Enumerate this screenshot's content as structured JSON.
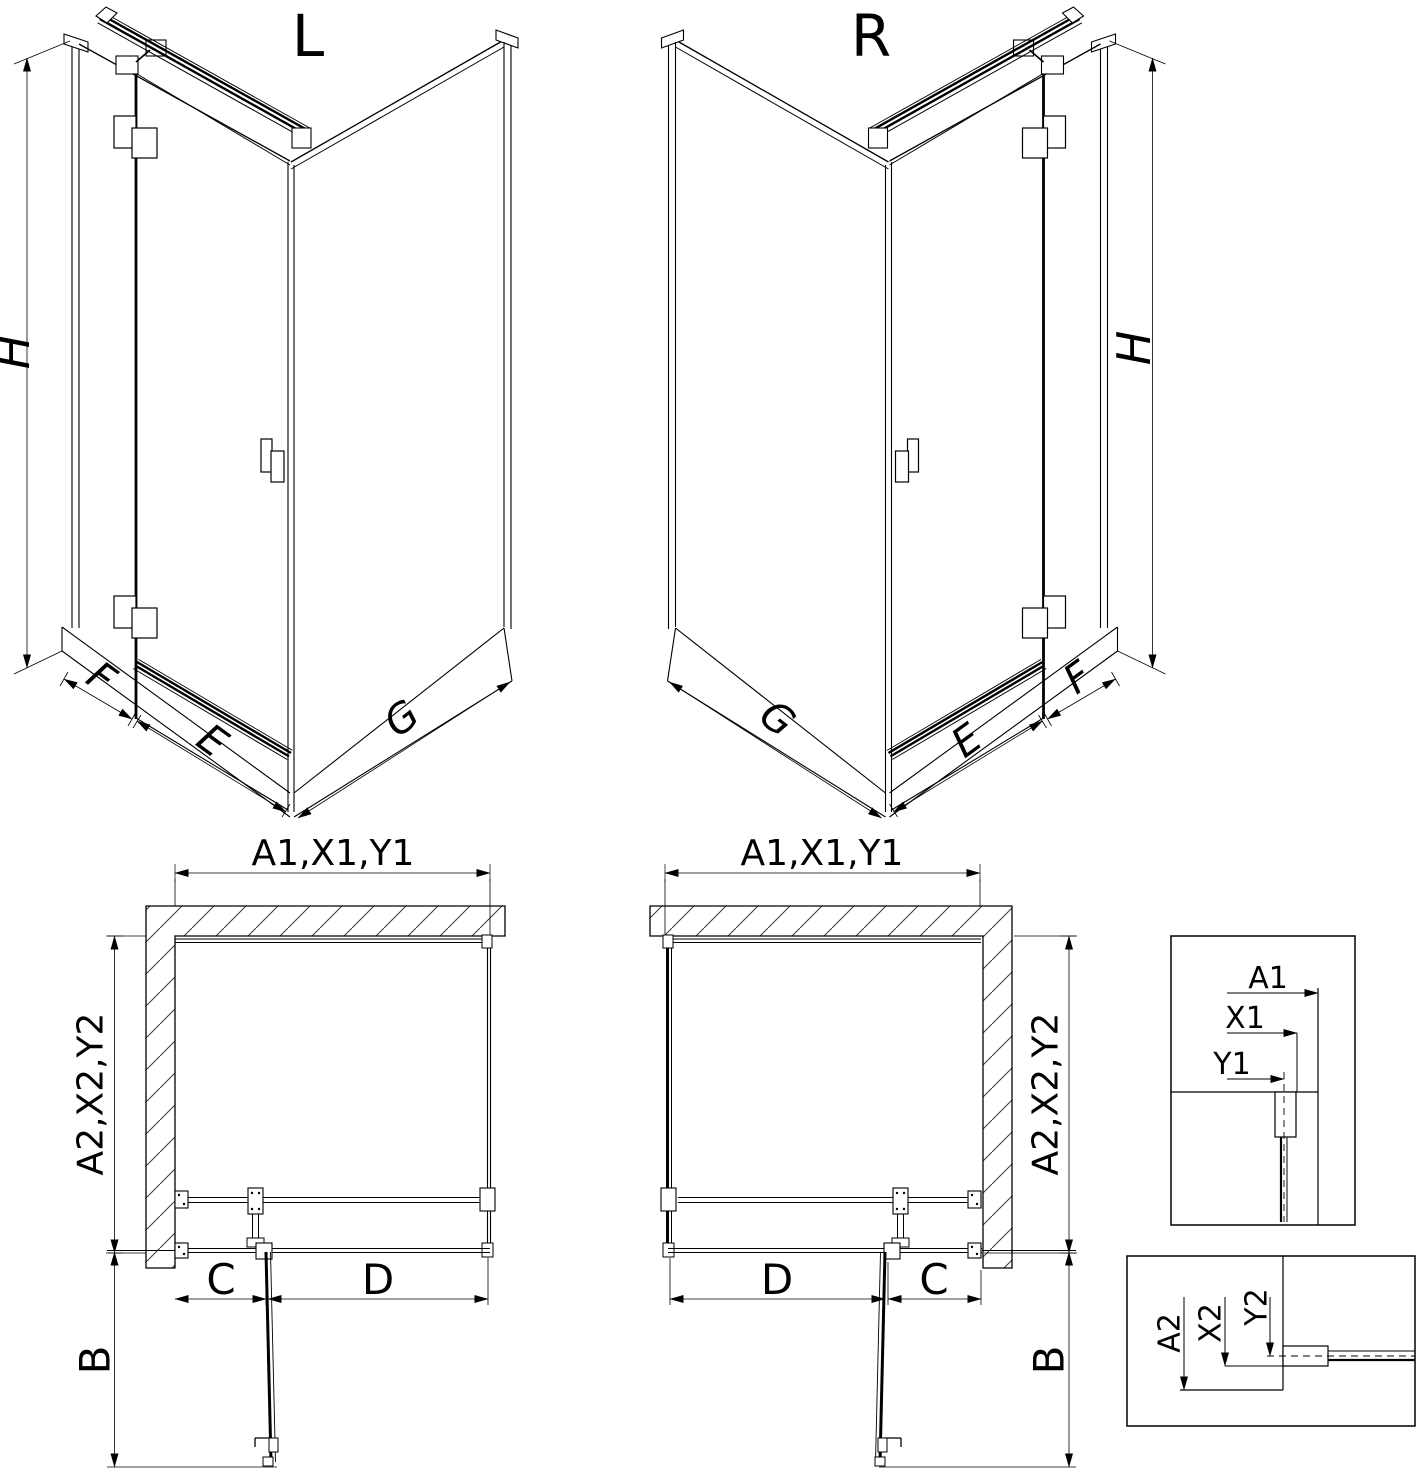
{
  "colors": {
    "line": "#000000",
    "background": "#ffffff"
  },
  "labels": {
    "iso_left": {
      "title": "L",
      "h": "H",
      "f": "F",
      "e": "E",
      "g": "G"
    },
    "iso_right": {
      "title": "R",
      "h": "H",
      "f": "F",
      "e": "E",
      "g": "G"
    },
    "plan_left": {
      "top_dim": "A1,X1,Y1",
      "side_dim": "A2,X2,Y2",
      "c": "C",
      "d": "D",
      "b": "B"
    },
    "plan_right": {
      "top_dim": "A1,X1,Y1",
      "side_dim": "A2,X2,Y2",
      "c": "C",
      "d": "D",
      "b": "B"
    },
    "detail_top": {
      "a1": "A1",
      "x1": "X1",
      "y1": "Y1"
    },
    "detail_bottom": {
      "a2": "A2",
      "x2": "X2",
      "y2": "Y2"
    }
  }
}
